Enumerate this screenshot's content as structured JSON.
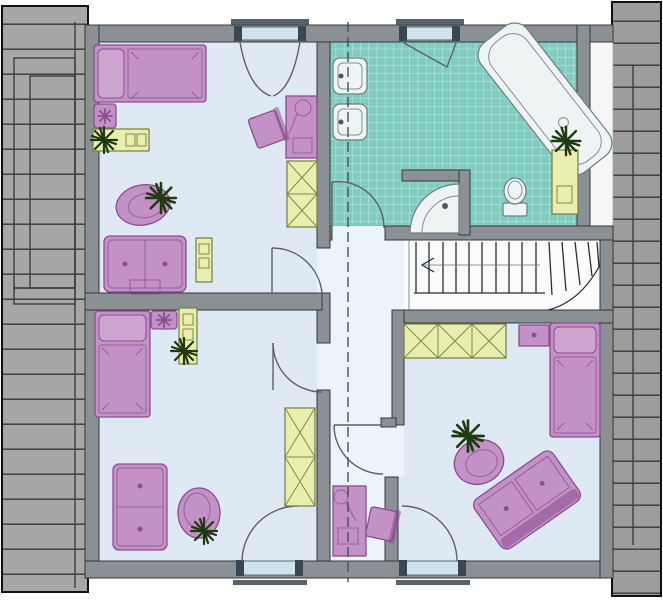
{
  "meta": {
    "type": "architectural-floor-plan",
    "floor": "attic-storey",
    "visible_text_labels": []
  },
  "palette": {
    "bg": "#ffffff",
    "wall": "#8b9094",
    "wall_edge": "#34383c",
    "roof": "#a7a7a7",
    "roof_dark": "#9d9d9d",
    "roof_line": "#3f3f3f",
    "room_floor": "#dfe9f4",
    "hall_floor": "#edf3fa",
    "strip": "#f6f6f6",
    "tile": "#80ccc0",
    "tile_line": "#ffffff",
    "fixture": "#eef3f3",
    "fixture_edge": "#6e7e86",
    "furn_purple": "#c391c6",
    "furn_purple_light": "#cda4d0",
    "furn_purple_edge": "#8a4d92",
    "furn_yellow": "#e9eeb0",
    "furn_yellow_edge": "#75803c",
    "window": "#cfe3ef",
    "window_cap": "#3b4750",
    "plant": "#1e3a10",
    "section": "#4a4f54"
  },
  "structure": {
    "roof_areas": [
      "roof-area-west",
      "roof-area-east"
    ],
    "section_line": "vertical-dash-line",
    "staircase": "winder-staircase",
    "windows": [
      "northwest-casement-window",
      "bathroom-tilt-window",
      "southwest-french-window",
      "southeast-french-window"
    ],
    "doors": [
      "northwest-room-door",
      "southwest-room-door",
      "southeast-room-door",
      "bathroom-door"
    ]
  },
  "rooms": [
    {
      "name": "bedroom-northwest",
      "furniture": [
        "single-bed",
        "cushion-stool-with-flower",
        "shelf-with-plant",
        "round-pouf-with-plant",
        "sideboard",
        "small-shelf",
        "desk-with-lamp",
        "desk-chair",
        "two-section-wardrobe"
      ]
    },
    {
      "name": "bathroom",
      "furniture": [
        "washbasin",
        "washbasin",
        "corner-bathtub-diagonal",
        "bath-cabinet-with-plant",
        "toilet",
        "corner-shower"
      ]
    },
    {
      "name": "bedroom-southwest",
      "furniture": [
        "single-bed",
        "cushion-stool-with-flower",
        "shelf-with-plant",
        "sideboard",
        "round-pouf-with-plant",
        "two-section-wardrobe"
      ]
    },
    {
      "name": "bedroom-southeast",
      "furniture": [
        "three-section-wardrobe",
        "nightstand",
        "single-bed",
        "sofa-diagonal",
        "round-pouf-with-plant"
      ]
    },
    {
      "name": "hallway",
      "furniture": [
        "desk-with-lamp",
        "desk-chair"
      ]
    }
  ]
}
